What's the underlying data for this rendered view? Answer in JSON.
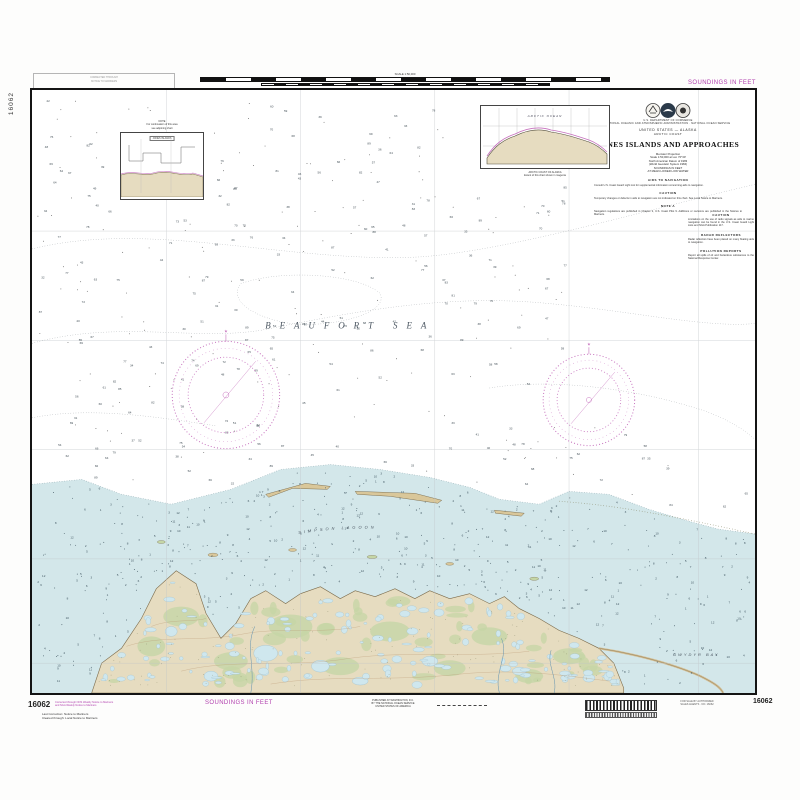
{
  "chart": {
    "number": "16062",
    "soundings_note": "SOUNDINGS IN FEET",
    "sea_label": "BEAUFORT SEA",
    "lagoon_label": "SIMPSON LAGOON",
    "bay_label": "GWYDYR BAY",
    "title_block": {
      "agency_line1": "U.S. DEPARTMENT OF COMMERCE",
      "agency_line2": "NATIONAL OCEANIC AND ATMOSPHERIC ADMINISTRATION · NATIONAL OCEAN SERVICE",
      "country": "UNITED STATES — ALASKA",
      "region": "ARCTIC COAST",
      "title": "JONES ISLANDS AND APPROACHES",
      "lines": [
        "Mercator Projection",
        "Scale 1:50,000 at Lat. 70°30'",
        "North American Datum of 1983",
        "(World Geodetic System 1984)",
        "SOUNDINGS IN FEET",
        "AT MEAN LOWER LOW WATER"
      ]
    },
    "notes_center": [
      {
        "heading": "AIDS TO NAVIGATION",
        "body": "Consult U.S. Coast Guard Light List for supplemental information concerning aids to navigation."
      },
      {
        "heading": "CAUTION",
        "body": "Temporary changes or defects in aids to navigation are not indicated on this chart. See Local Notice to Mariners."
      },
      {
        "heading": "NOTE A",
        "body": "Navigation regulations are published in Chapter 2, U.S. Coast Pilot 9. Additions or revisions are published in the Notices to Mariners."
      }
    ],
    "notes_right": [
      {
        "heading": "CAUTION",
        "body": "Limitations on the use of radio signals as aids to marine navigation can be found in the U.S. Coast Guard Light Lists and NGA Publication 117."
      },
      {
        "heading": "RADAR REFLECTORS",
        "body": "Radar reflectors have been placed on many floating aids to navigation."
      },
      {
        "heading": "POLLUTION REPORTS",
        "body": "Report all spills of oil and hazardous substances to the National Response Center."
      }
    ],
    "inset_top": {
      "ocean_label": "ARCTIC OCEAN",
      "caption1": "ARCTIC COAST OF ALASKA",
      "caption2": "Extent of this chart shown in magenta"
    },
    "inset_left": {
      "bar_label": "JONES ISLANDS",
      "caption1": "NOTE",
      "caption2": "For continuation of this area",
      "caption3": "see adjoining chart"
    },
    "top_margin": {
      "scale_label": "SCALE 1:50,000",
      "stamp_line1": "CORRECTED THROUGH",
      "stamp_line2": "NOTICE TO MARINERS",
      "soundings": "SOUNDINGS IN FEET"
    },
    "bottom_margin": {
      "number_left": "16062",
      "magenta_line1": "Corrected through NOS Weekly Notice to Mariners",
      "magenta_line2": "and NGA Weekly Notice to Mariners",
      "black_line1": "Last Correction: Notice to Mariners",
      "black_line2": "Cleared through: Local Notice to Mariners",
      "soundings": "SOUNDINGS IN FEET",
      "pub_line1": "PUBLISHED AT WASHINGTON, D.C.",
      "pub_line2": "BY THE NATIONAL OCEAN SERVICE",
      "pub_line3": "UNITED STATES OF AMERICA",
      "sale_line1": "FOR SALE BY AUTHORIZED",
      "sale_line2": "SALES AGENTS · NO. 16062",
      "number_right": "16062"
    },
    "side_number": "16062",
    "colors": {
      "magenta": "#b13fae",
      "shallow_water": "#d3e7ea",
      "land": "#e6dcc0",
      "tundra_green": "#c5d6a6",
      "lake": "#cfe7ee"
    }
  }
}
